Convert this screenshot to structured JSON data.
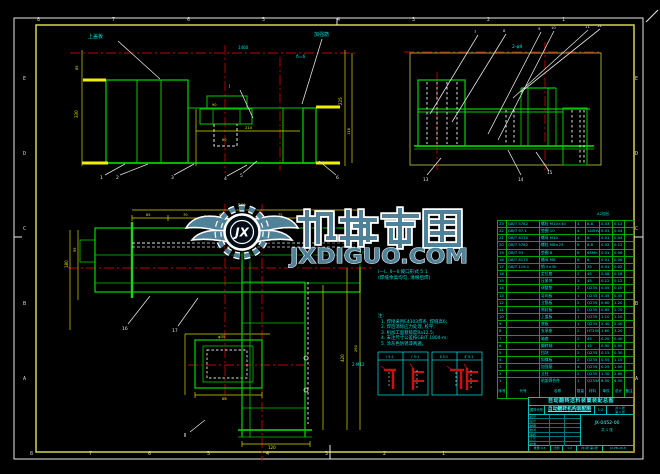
{
  "frame": {
    "zone_numbers_top": [
      "8",
      "7",
      "6",
      "5",
      "4",
      "3",
      "2",
      "1"
    ],
    "zone_numbers_bottom": [
      "8",
      "7",
      "6",
      "5",
      "4",
      "3",
      "2",
      "1"
    ],
    "zone_letters_left": [
      "E",
      "D",
      "C",
      "B",
      "A"
    ],
    "zone_letters_right": [
      "E",
      "D",
      "C",
      "B",
      "A"
    ]
  },
  "watermark": {
    "logo_initials": "JX",
    "title": "机械帝国",
    "domain": "JXDIGUO.COM",
    "color": "#4f8299"
  },
  "drawing_labels": [
    {
      "t": "上盖板",
      "x": 88,
      "y": 38,
      "c": "cy",
      "s": 5
    },
    {
      "t": "加强筋",
      "x": 314,
      "y": 36,
      "c": "cy",
      "s": 5
    },
    {
      "t": "δ=6",
      "x": 296,
      "y": 58,
      "c": "cy",
      "s": 4.5
    },
    {
      "t": "Ⅰ",
      "x": 229,
      "y": 88,
      "c": "cy",
      "s": 5
    },
    {
      "t": "1460",
      "x": 238,
      "y": 49,
      "c": "cy",
      "s": 4
    },
    {
      "t": "1",
      "x": 100,
      "y": 179,
      "c": "w",
      "s": 4.5
    },
    {
      "t": "2",
      "x": 116,
      "y": 179,
      "c": "w",
      "s": 4.5
    },
    {
      "t": "3",
      "x": 171,
      "y": 179,
      "c": "w",
      "s": 4.5
    },
    {
      "t": "4",
      "x": 224,
      "y": 180,
      "c": "w",
      "s": 4.5
    },
    {
      "t": "5",
      "x": 240,
      "y": 177,
      "c": "w",
      "s": 4.5
    },
    {
      "t": "6",
      "x": 336,
      "y": 179,
      "c": "w",
      "s": 4.5
    },
    {
      "t": "330",
      "x": 78,
      "y": 118,
      "c": "y",
      "s": 4,
      "r": -90
    },
    {
      "t": "85",
      "x": 78,
      "y": 70,
      "c": "y",
      "s": 3.6,
      "r": -90
    },
    {
      "t": "225",
      "x": 342,
      "y": 105,
      "c": "y",
      "s": 4,
      "r": -90
    },
    {
      "t": "118",
      "x": 350,
      "y": 135,
      "c": "y",
      "s": 3.6,
      "r": -90
    },
    {
      "t": "210",
      "x": 245,
      "y": 129,
      "c": "y",
      "s": 3.8
    },
    {
      "t": "90",
      "x": 212,
      "y": 106,
      "c": "y",
      "s": 3.6
    },
    {
      "t": "60",
      "x": 222,
      "y": 141,
      "c": "y",
      "s": 3.6
    },
    {
      "t": "2-φ9",
      "x": 512,
      "y": 48,
      "c": "cy",
      "s": 4.5
    },
    {
      "t": "7",
      "x": 474,
      "y": 33,
      "c": "w",
      "s": 3.8
    },
    {
      "t": "8",
      "x": 503,
      "y": 32,
      "c": "w",
      "s": 3.8
    },
    {
      "t": "9",
      "x": 538,
      "y": 30,
      "c": "w",
      "s": 3.8
    },
    {
      "t": "10",
      "x": 551,
      "y": 29,
      "c": "w",
      "s": 3.8
    },
    {
      "t": "11",
      "x": 585,
      "y": 28,
      "c": "w",
      "s": 3.8
    },
    {
      "t": "12",
      "x": 597,
      "y": 27,
      "c": "w",
      "s": 3.8
    },
    {
      "t": "13",
      "x": 423,
      "y": 181,
      "c": "w",
      "s": 4.2
    },
    {
      "t": "14",
      "x": 518,
      "y": 181,
      "c": "w",
      "s": 4.2
    },
    {
      "t": "15",
      "x": 547,
      "y": 174,
      "c": "w",
      "s": 4.2
    },
    {
      "t": "560",
      "x": 238,
      "y": 207,
      "c": "y",
      "s": 4
    },
    {
      "t": "65",
      "x": 146,
      "y": 216,
      "c": "y",
      "s": 3.6
    },
    {
      "t": "70",
      "x": 183,
      "y": 216,
      "c": "y",
      "s": 3.6
    },
    {
      "t": "65",
      "x": 219,
      "y": 216,
      "c": "y",
      "s": 3.6
    },
    {
      "t": "40",
      "x": 248,
      "y": 216,
      "c": "y",
      "s": 3.6
    },
    {
      "t": "75",
      "x": 278,
      "y": 216,
      "c": "y",
      "s": 3.6
    },
    {
      "t": "180",
      "x": 68,
      "y": 268,
      "c": "y",
      "s": 4,
      "r": -90
    },
    {
      "t": "95",
      "x": 76,
      "y": 252,
      "c": "y",
      "s": 3.6,
      "r": -90
    },
    {
      "t": "86",
      "x": 222,
      "y": 400,
      "c": "y",
      "s": 3.8
    },
    {
      "t": "φ35",
      "x": 218,
      "y": 338,
      "c": "y",
      "s": 3.8
    },
    {
      "t": "420",
      "x": 344,
      "y": 362,
      "c": "y",
      "s": 4,
      "r": -90
    },
    {
      "t": "260",
      "x": 357,
      "y": 352,
      "c": "y",
      "s": 3.6,
      "r": -90
    },
    {
      "t": "2-M12",
      "x": 352,
      "y": 366,
      "c": "cy",
      "s": 4
    },
    {
      "t": "120",
      "x": 268,
      "y": 449,
      "c": "y",
      "s": 4
    },
    {
      "t": "16",
      "x": 122,
      "y": 330,
      "c": "w",
      "s": 4.5
    },
    {
      "t": "17",
      "x": 172,
      "y": 332,
      "c": "w",
      "s": 4.5
    },
    {
      "t": "Ⅱ",
      "x": 184,
      "y": 437,
      "c": "w",
      "s": 5
    },
    {
      "t": "Ⅳ",
      "x": 362,
      "y": 254,
      "c": "cy",
      "s": 4
    }
  ],
  "notes": {
    "title_lines": [
      "Ⅰ—Ⅰ、Ⅱ—Ⅱ 坡口形式 5:1",
      "(焊缝余高均匀, 清根后焊)"
    ],
    "prefix": "注:",
    "items": [
      "1. 焊接采用E4303焊条, 焊缝高6;",
      "2. 焊后消除应力处理, 校平;",
      "3. 机加工面粗糙度Ra12.5;",
      "4. 未注尺寸公差按GB/T 1804-m;",
      "5. 涂灰色防锈漆两遍。"
    ]
  },
  "weld_details": {
    "cells": [
      "Ⅰ 5:1",
      "Ⅰ′ 5:1",
      "Ⅱ 5:1",
      "Ⅱ′ 5:1"
    ]
  },
  "bom": {
    "sheet_note": "A2加长",
    "header": [
      "序号",
      "代号",
      "名称",
      "数量",
      "材料",
      "单件",
      "总计",
      "备注"
    ],
    "rows": [
      [
        "23",
        "GB/T 5782",
        "螺栓 M10×40",
        "4",
        "8.8",
        "0.03",
        "0.12",
        ""
      ],
      [
        "22",
        "GB/T 97.1",
        "垫圈 10",
        "4",
        "140HV",
        "0.01",
        "0.04",
        ""
      ],
      [
        "21",
        "GB/T 6170",
        "螺母 M10",
        "4",
        "8",
        "0.01",
        "0.04",
        ""
      ],
      [
        "20",
        "GB/T 5782",
        "螺栓 M8×25",
        "6",
        "8.8",
        "0.02",
        "0.12",
        ""
      ],
      [
        "19",
        "GB/T 93",
        "垫圈 8",
        "6",
        "65Mn",
        "0.01",
        "0.06",
        ""
      ],
      [
        "18",
        "GB/T 6170",
        "螺母 M8",
        "6",
        "8",
        "0.01",
        "0.06",
        ""
      ],
      [
        "17",
        "GB/T 119.1",
        "销 5×30",
        "2",
        "35",
        "0.01",
        "0.02",
        ""
      ],
      [
        "16",
        "",
        "定位套",
        "2",
        "45",
        "0.08",
        "0.16",
        ""
      ],
      [
        "15",
        "",
        "压紧块",
        "1",
        "45",
        "0.12",
        "0.12",
        ""
      ],
      [
        "14",
        "",
        "调整垫",
        "2",
        "Q235",
        "0.05",
        "0.10",
        ""
      ],
      [
        "13",
        "",
        "导向板",
        "1",
        "Q235",
        "0.45",
        "0.45",
        ""
      ],
      [
        "12",
        "",
        "立筋板",
        "2",
        "Q235",
        "0.60",
        "1.20",
        ""
      ],
      [
        "11",
        "",
        "侧封板",
        "2",
        "Q235",
        "0.85",
        "1.70",
        ""
      ],
      [
        "10",
        "",
        "上盖板",
        "1",
        "Q235",
        "1.10",
        "1.10",
        ""
      ],
      [
        "9",
        "",
        "底板",
        "1",
        "Q235",
        "2.40",
        "2.40",
        ""
      ],
      [
        "8",
        "",
        "支承座",
        "2",
        "HT200",
        "1.60",
        "3.20",
        ""
      ],
      [
        "7",
        "",
        "轴套",
        "2",
        "45",
        "0.20",
        "0.40",
        ""
      ],
      [
        "6",
        "",
        "翻转轴",
        "1",
        "45",
        "0.90",
        "0.90",
        ""
      ],
      [
        "5",
        "",
        "挡块",
        "2",
        "Q235",
        "0.15",
        "0.30",
        ""
      ],
      [
        "4",
        "",
        "斜撑板",
        "2",
        "Q235",
        "0.55",
        "1.10",
        ""
      ],
      [
        "3",
        "",
        "加强筋",
        "4",
        "Q235",
        "0.25",
        "1.00",
        ""
      ],
      [
        "2",
        "",
        "立柱",
        "2",
        "Q235",
        "1.30",
        "2.60",
        ""
      ],
      [
        "1",
        "",
        "机架焊合件",
        "1",
        "Q235A",
        "6.50",
        "6.50",
        ""
      ]
    ]
  },
  "title_block": {
    "caption": "自动翻转送料装置装配总图",
    "org_label": "图样代号",
    "drawing_name": "自动翻转机构装配图",
    "scale_value": "1:2",
    "sheets": "共 1 张",
    "sheet_no": "第 1 张",
    "fields": [
      "标记",
      "设计",
      "制图",
      "校对",
      "审核",
      "工艺",
      "批准"
    ],
    "doc_number": "JX-0452-00",
    "doc_sub": "共 1 张",
    "bottom_cells": [
      "重量 0.8",
      "比例",
      "1:2",
      "共1张 第1张",
      "JX-PB-20-8"
    ]
  }
}
